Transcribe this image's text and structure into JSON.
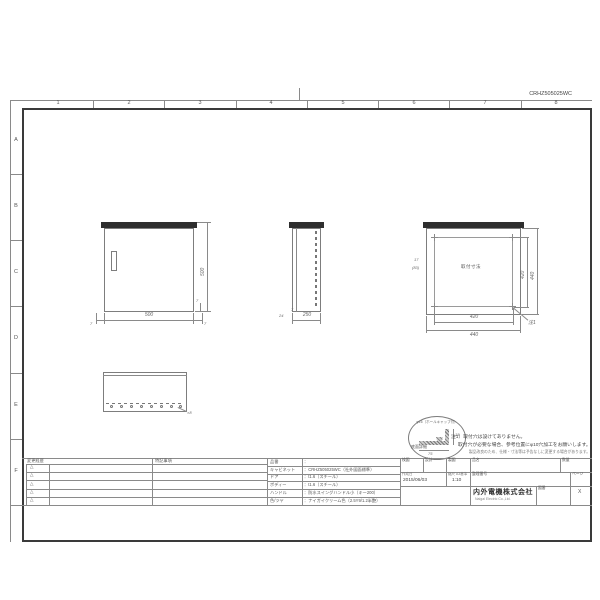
{
  "sheet": {
    "drawing_no": "CRHZ505025WC",
    "grid_cols": [
      "1",
      "2",
      "3",
      "4",
      "5",
      "6",
      "7",
      "8"
    ],
    "grid_rows": [
      "A",
      "B",
      "C",
      "D",
      "E",
      "F"
    ]
  },
  "views": {
    "front": {
      "dim_width": "500",
      "dim_height": "500",
      "dim_overhang_left": "7",
      "dim_overhang_right": "7",
      "dim_gap": "7"
    },
    "side": {
      "dim_depth": "250",
      "dim_door": "24",
      "dim_gap": "7"
    },
    "rear": {
      "label": "取付寸法",
      "dim_pitch_w": "420",
      "dim_overall_w": "440",
      "dim_pitch_h": "420",
      "dim_overall_h": "440",
      "dim_left_top": "17",
      "dim_left_bottom": "(83)",
      "note_ref": "注1"
    },
    "bottom": {
      "hole_count": "×8"
    },
    "detail": {
      "hole_label": "φ16（ホールキャップ付）",
      "dim_height": "15",
      "dim_offset": "75",
      "caption": "底面詳細"
    }
  },
  "notes": {
    "disclaimer": "製品改良のため、仕様・寸法等は予告なしに変更する場合があります。",
    "note1_line1": "注1）取付穴は設けてありません。",
    "note1_line2": "取付穴が必要な場合、参考位置にφ10穴加工をお願いします。"
  },
  "titleblock": {
    "revision_header": "変更経歴",
    "notes_header": "特記事項",
    "revision_mark": "△",
    "specs": [
      {
        "label": "品番",
        "value": "："
      },
      {
        "label": "キャビネット",
        "value": "：CRHZ505025WC（社外図面標準）"
      },
      {
        "label": "ドア",
        "value": "：t1.6（スチール）"
      },
      {
        "label": "ボディー",
        "value": "：t1.6（スチール）"
      },
      {
        "label": "ハンドル",
        "value": "：防水スイングハンドル小（キー200）"
      },
      {
        "label": "色/ツヤ",
        "value": "：ナイガイクリーム色（2.5Y9/1.2半艶）"
      }
    ],
    "approval": {
      "check": "検図",
      "design": "設計",
      "draft": "製図"
    },
    "product_label": "品名",
    "qty_label": "数量",
    "created_label": "作成日",
    "created_date": "2015/06/03",
    "scale_label": "縮尺",
    "scale_basis": "A3基準",
    "scale_value": "1:10",
    "ref_label": "整理番号",
    "page_label": "ページ",
    "company_name": "内外電機株式会社",
    "company_name_en": "Naigai Electric Co.,Ltd.",
    "drawing_no_label": "図番",
    "sheet_mark": "X"
  }
}
